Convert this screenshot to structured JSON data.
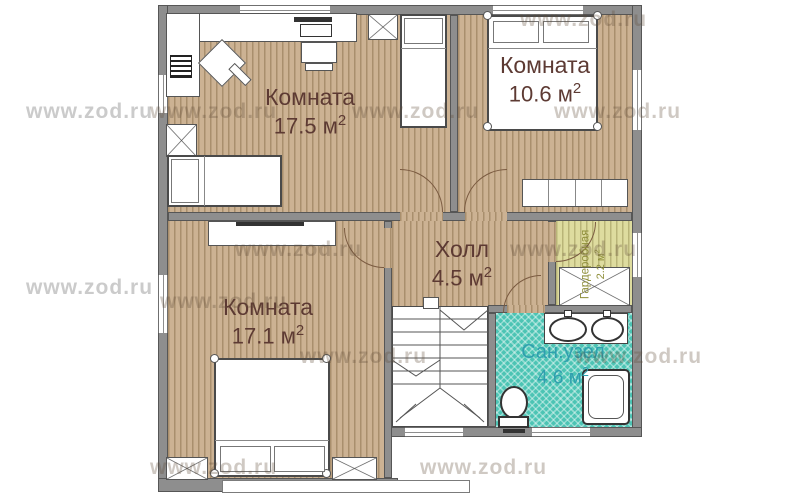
{
  "watermark": {
    "text": "www.zod.ru"
  },
  "rooms": [
    {
      "id": "room-17-5",
      "label": "Комната",
      "value": "17.5",
      "unit": "м",
      "sup": "2"
    },
    {
      "id": "room-10-6",
      "label": "Комната",
      "value": "10.6",
      "unit": "м",
      "sup": "2"
    },
    {
      "id": "room-17-1",
      "label": "Комната",
      "value": "17.1",
      "unit": "м",
      "sup": "2"
    },
    {
      "id": "hall",
      "label": "Холл",
      "value": "4.5",
      "unit": "м",
      "sup": "2"
    },
    {
      "id": "wardrobe",
      "label": "Гардеробная",
      "value": "2.2",
      "unit": "м",
      "sup": "2"
    },
    {
      "id": "bathroom",
      "label": "Сан.узел",
      "value": "4.6",
      "unit": "м",
      "sup": "2"
    }
  ],
  "colors": {
    "wall": "#8e8e8e",
    "wall_outline": "#565656",
    "floor_wood": "#ccb293",
    "floor_wood_stripe": "#a98f6d",
    "floor_wardrobe": "#dedc9f",
    "floor_wardrobe_stripe": "#b9b578",
    "floor_bathroom": "#4cc4b4",
    "label_rooms": "#5d3a33",
    "label_wardrobe": "#8f8f3a",
    "label_bathroom": "#2f9fae",
    "watermark_outside": "#cbcbcb",
    "watermark_on_floor": "rgba(95,75,55,0.30)"
  }
}
